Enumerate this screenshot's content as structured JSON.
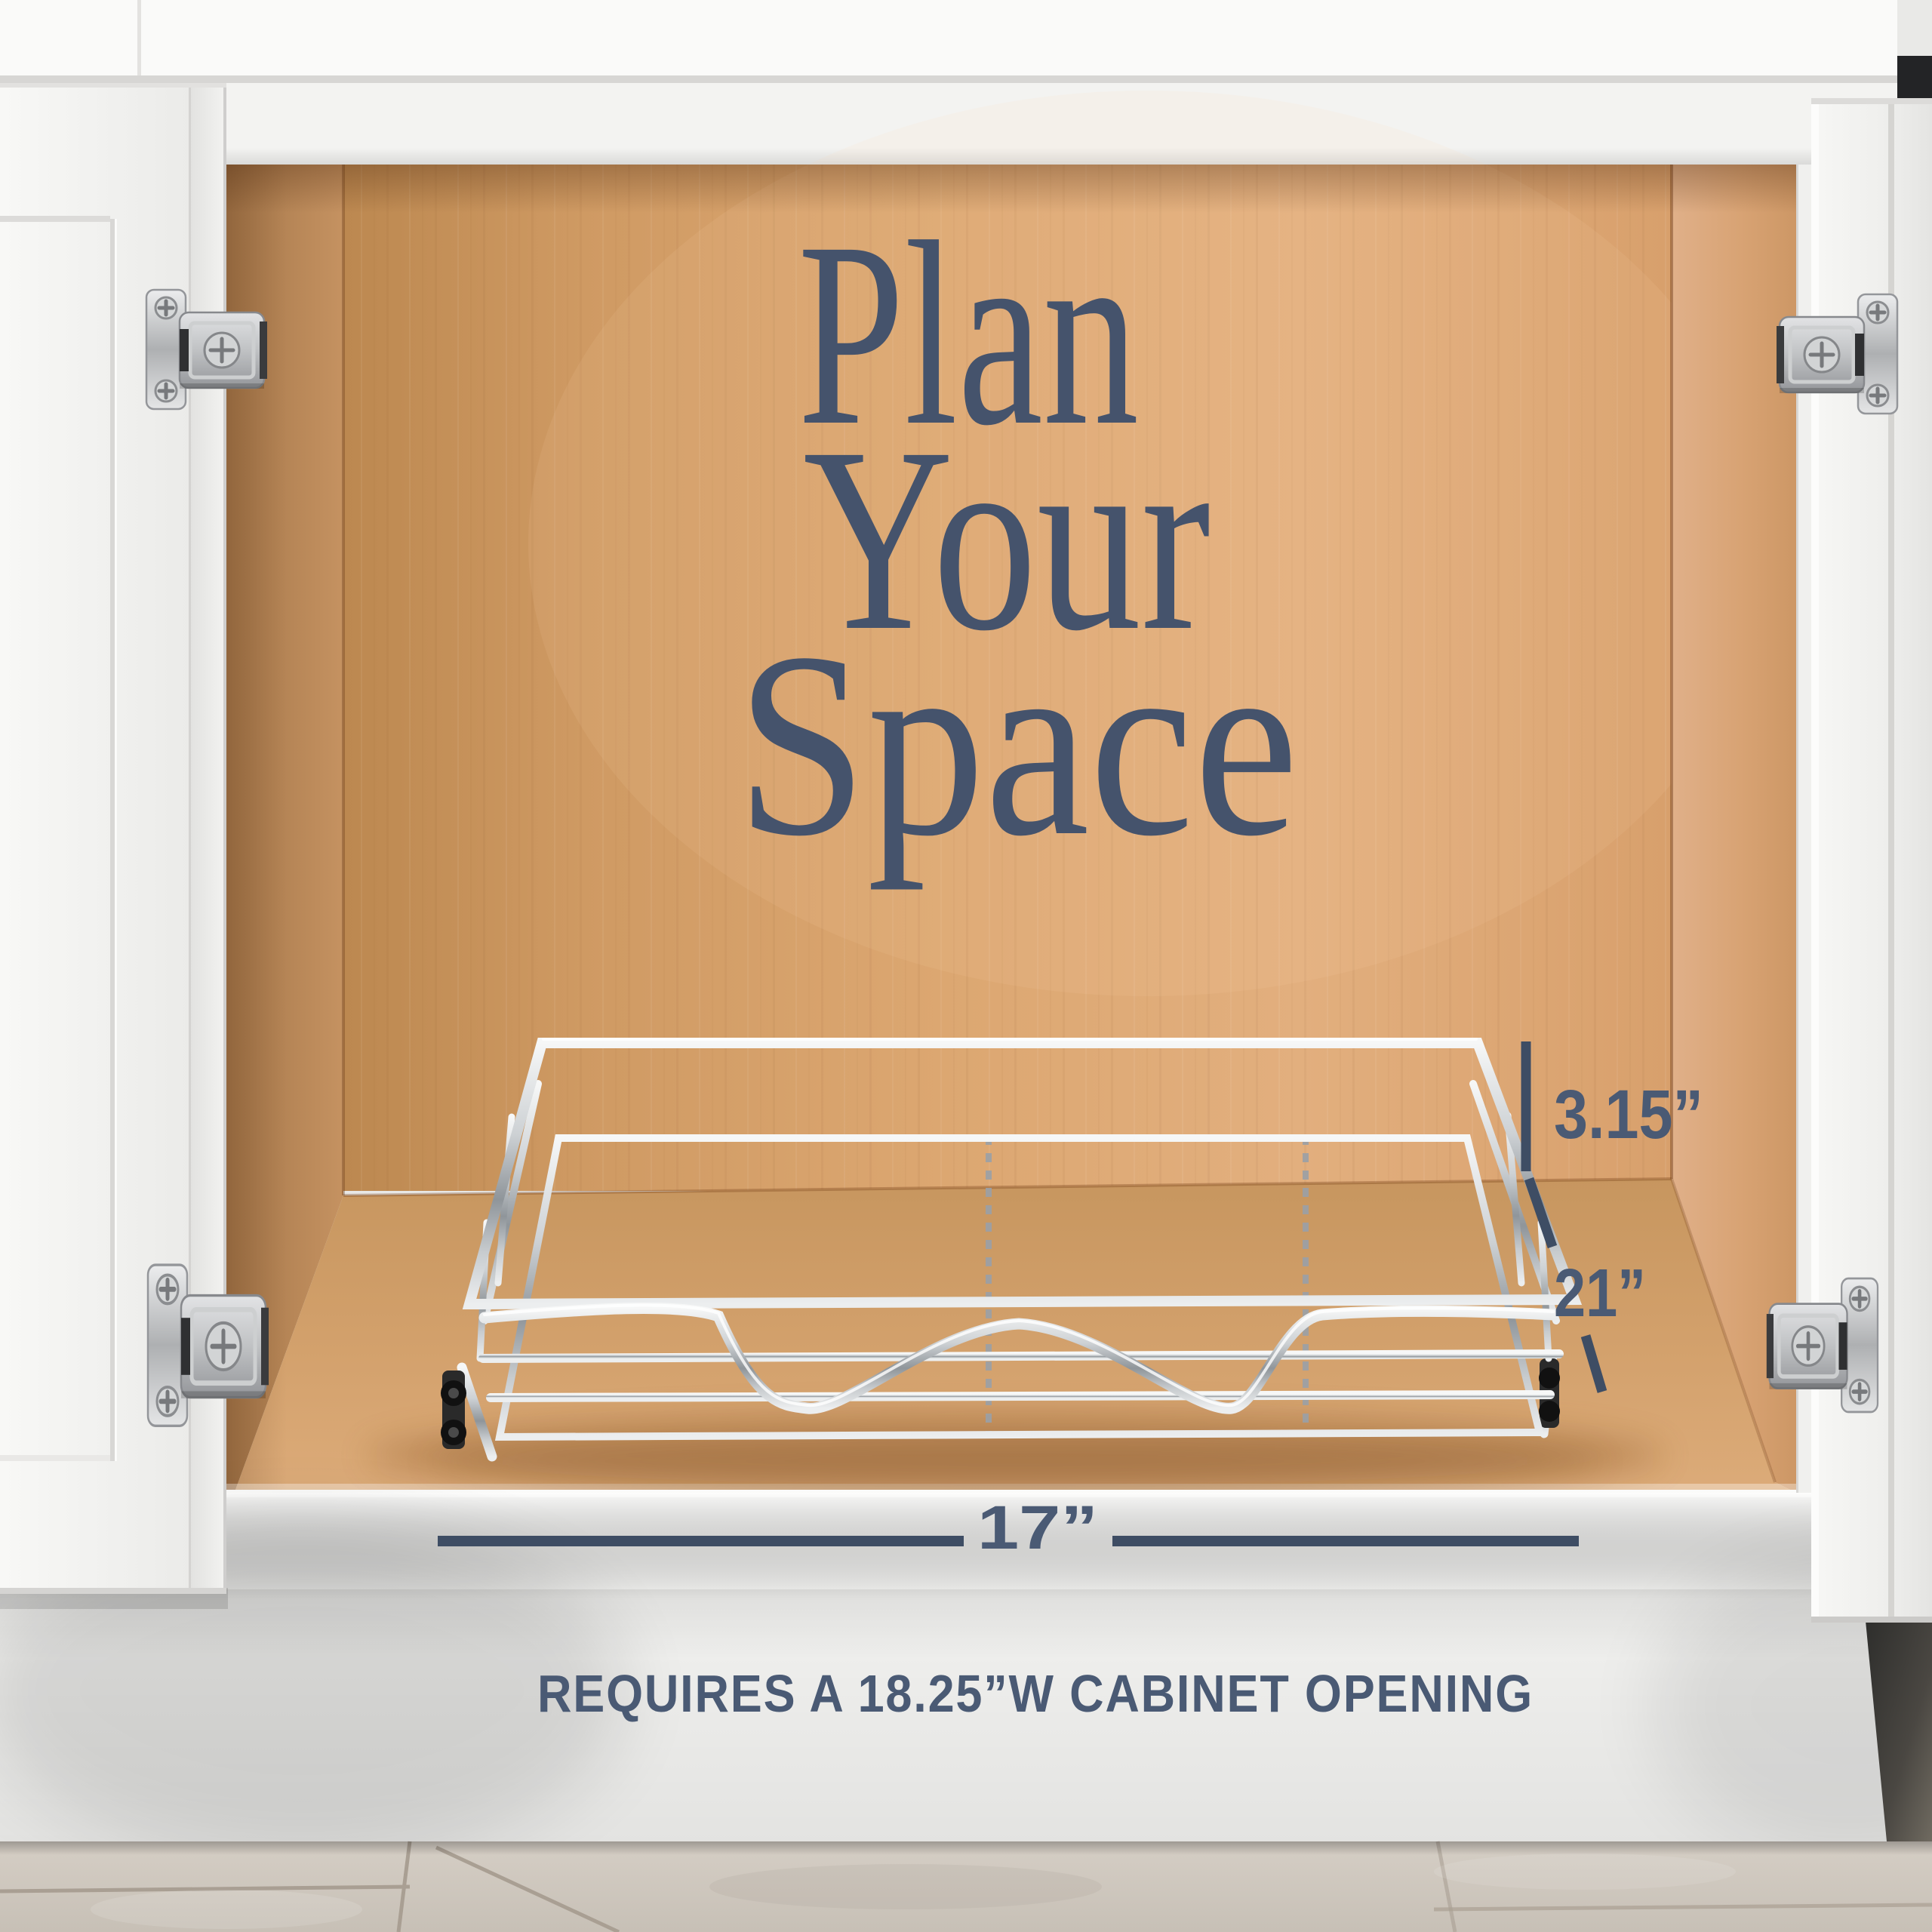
{
  "overlay": {
    "headline": [
      "Plan",
      "Your",
      "Space"
    ],
    "dimensions": {
      "height_label": "3.15”",
      "depth_label": "21”",
      "width_label": "17”"
    },
    "footer_note": "REQUIRES A 18.25”W CABINET OPENING"
  },
  "colors": {
    "headline": "#45536c",
    "dimension_text": "#4a5a74",
    "dimension_line": "#3e4d64",
    "cabinet_wood": "#d9a46f",
    "cabinet_white": "#f3f3f1",
    "chrome": "#c9cdd0",
    "tile_floor": "#cfc8bf"
  }
}
